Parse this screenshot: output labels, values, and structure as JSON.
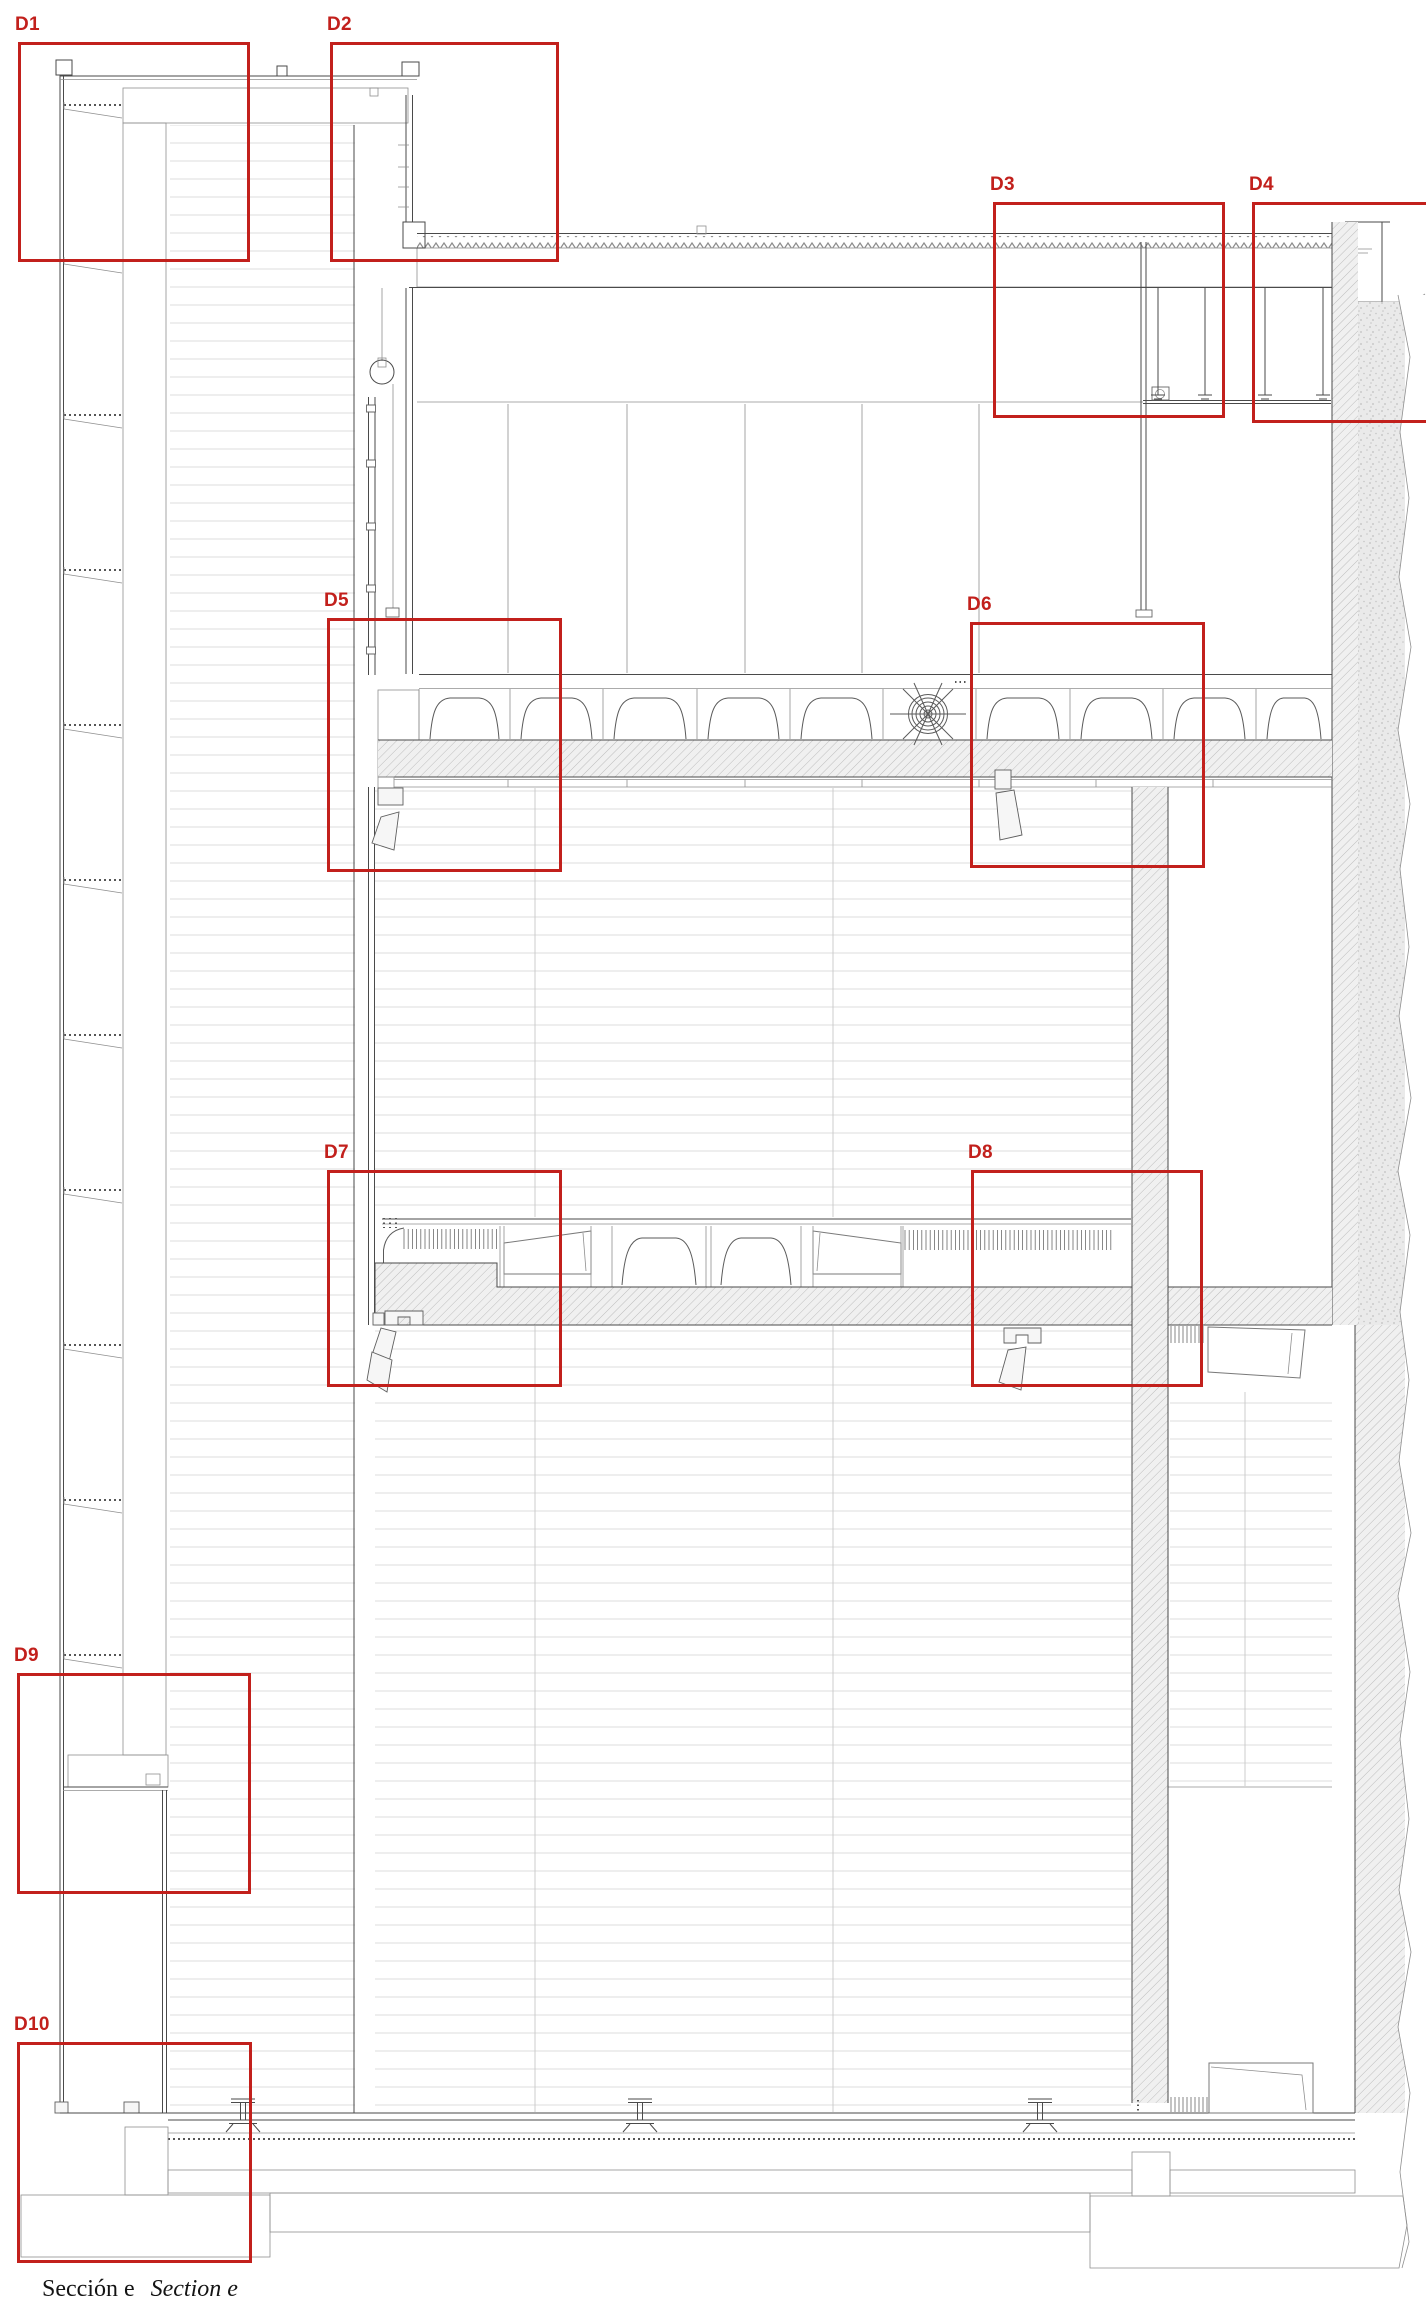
{
  "document": {
    "caption_es": "Sección e",
    "caption_en": "Section e"
  },
  "annotation_color": "#c2201c",
  "callouts": [
    {
      "id": "D1",
      "label": "D1",
      "x": 18,
      "y": 42,
      "w": 232,
      "h": 220
    },
    {
      "id": "D2",
      "label": "D2",
      "x": 330,
      "y": 42,
      "w": 229,
      "h": 220
    },
    {
      "id": "D3",
      "label": "D3",
      "x": 993,
      "y": 202,
      "w": 232,
      "h": 216
    },
    {
      "id": "D4",
      "label": "D4",
      "x": 1252,
      "y": 202,
      "w": 182,
      "h": 221
    },
    {
      "id": "D5",
      "label": "D5",
      "x": 327,
      "y": 618,
      "w": 235,
      "h": 254
    },
    {
      "id": "D6",
      "label": "D6",
      "x": 970,
      "y": 622,
      "w": 235,
      "h": 246
    },
    {
      "id": "D7",
      "label": "D7",
      "x": 327,
      "y": 1170,
      "w": 235,
      "h": 217
    },
    {
      "id": "D8",
      "label": "D8",
      "x": 971,
      "y": 1170,
      "w": 232,
      "h": 217
    },
    {
      "id": "D9",
      "label": "D9",
      "x": 17,
      "y": 1673,
      "w": 234,
      "h": 221
    },
    {
      "id": "D10",
      "label": "D10",
      "x": 17,
      "y": 2042,
      "w": 235,
      "h": 221
    }
  ]
}
